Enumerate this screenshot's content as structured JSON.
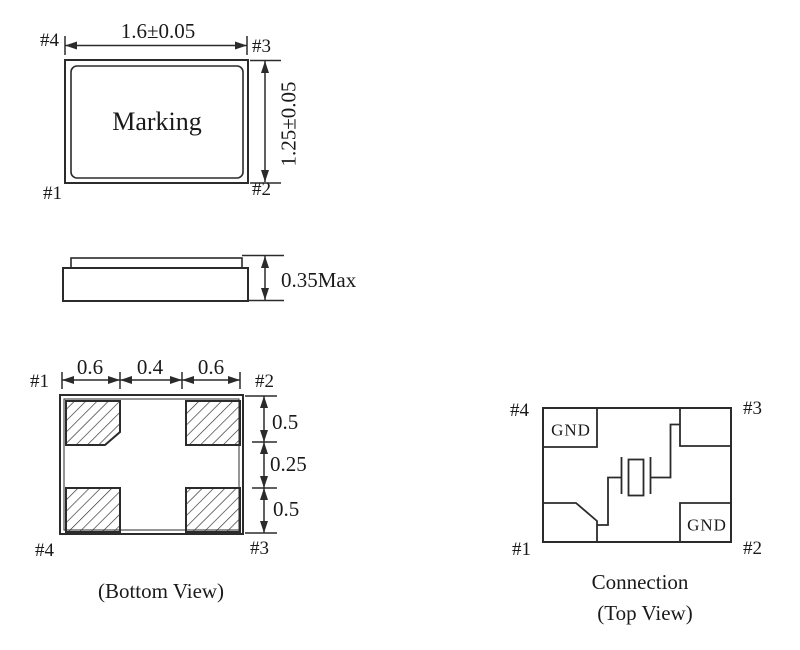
{
  "colors": {
    "line": "#2b2b2b",
    "text": "#1a1a1a",
    "background": "#ffffff"
  },
  "top_view": {
    "marking_label": "Marking",
    "width_dim": "1.6±0.05",
    "height_dim": "1.25±0.05",
    "pin_top_left": "#4",
    "pin_top_right": "#3",
    "pin_bottom_left": "#1",
    "pin_bottom_right": "#2"
  },
  "side_view": {
    "height_dim": "0.35Max"
  },
  "bottom_view": {
    "caption": "(Bottom View)",
    "pin_top_left": "#1",
    "pin_top_right": "#2",
    "pin_bottom_left": "#4",
    "pin_bottom_right": "#3",
    "horizontal_dims": [
      "0.6",
      "0.4",
      "0.6"
    ],
    "vertical_dims": [
      "0.5",
      "0.25",
      "0.5"
    ]
  },
  "connection_view": {
    "caption": "Connection",
    "caption_sub": "(Top View)",
    "pin_top_left": "#4",
    "pin_top_right": "#3",
    "pin_bottom_left": "#1",
    "pin_bottom_right": "#2",
    "gnd_top_left": "GND",
    "gnd_bottom_right": "GND"
  }
}
